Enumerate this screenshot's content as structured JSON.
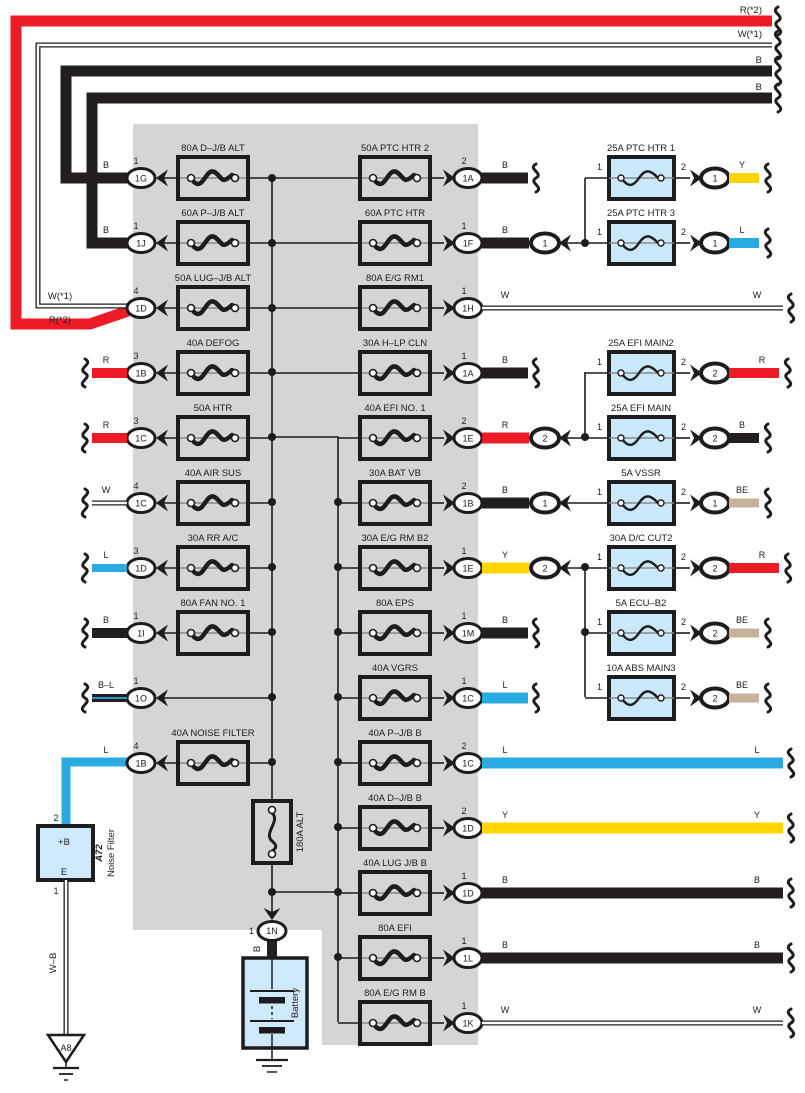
{
  "colors": {
    "R": "#EC1C27",
    "L": "#29ABE2",
    "Y": "#FFD400",
    "B": "#231F20",
    "BE": "#C7B299",
    "W": "#FFFFFF",
    "block_background": "#D4D5D7",
    "small_fuse_fill": "#C9E8FA",
    "component_fill": "#CDE9FA"
  },
  "top_wires": [
    {
      "label": "R(*2)",
      "near_label": "R(*2)",
      "color": "R"
    },
    {
      "label": "W(*1)",
      "near_label": "W(*1)",
      "color": "W"
    },
    {
      "label": "B",
      "color": "B"
    },
    {
      "label": "B",
      "color": "B"
    }
  ],
  "left_rows": [
    {
      "fuse": "80A D–J/B ALT",
      "pin": "1",
      "code": "1G",
      "wire": "B",
      "wire_code": "B",
      "src": "top"
    },
    {
      "fuse": "60A P–J/B ALT",
      "pin": "1",
      "code": "1J",
      "wire": "B",
      "wire_code": "B",
      "src": "top"
    },
    {
      "fuse": "50A LUG–J/B ALT",
      "pin": "4",
      "code": "1D",
      "wire": null,
      "wire_code": null,
      "src": "top"
    },
    {
      "fuse": "40A DEFOG",
      "pin": "3",
      "code": "1B",
      "wire": "R",
      "wire_code": "R",
      "src": "brace"
    },
    {
      "fuse": "50A HTR",
      "pin": "3",
      "code": "1C",
      "wire": "R",
      "wire_code": "R",
      "src": "brace"
    },
    {
      "fuse": "40A AIR SUS",
      "pin": "4",
      "code": "1C",
      "wire": "W",
      "wire_code": "W",
      "src": "brace"
    },
    {
      "fuse": "30A RR A/C",
      "pin": "3",
      "code": "1D",
      "wire": "L",
      "wire_code": "L",
      "src": "brace"
    },
    {
      "fuse": "80A FAN NO. 1",
      "pin": "1",
      "code": "1I",
      "wire": "B",
      "wire_code": "B",
      "src": "brace"
    },
    {
      "fuse": null,
      "pin": "1",
      "code": "1O",
      "wire": "B–L",
      "wire_code": "B-L",
      "src": "brace"
    },
    {
      "fuse": "40A NOISE FILTER",
      "pin": "4",
      "code": "1B",
      "wire": "L",
      "wire_code": "L",
      "src": "nf"
    }
  ],
  "middle_rows": [
    {
      "fuse": "50A PTC HTR 2",
      "pin": "2",
      "code": "1A",
      "wire": "B",
      "end": "short"
    },
    {
      "fuse": "60A PTC HTR",
      "pin": "1",
      "code": "1F",
      "wire": "B",
      "end": "oval",
      "oval": "1"
    },
    {
      "fuse": "80A E/G RM1",
      "pin": "1",
      "code": "1H",
      "wire": "W",
      "end": "long"
    },
    {
      "fuse": "30A H–LP CLN",
      "pin": "1",
      "code": "1A",
      "wire": "B",
      "end": "short"
    },
    {
      "fuse": "40A EFI NO. 1",
      "pin": "2",
      "code": "1E",
      "wire": "R",
      "end": "oval",
      "oval": "2"
    },
    {
      "fuse": "30A BAT VB",
      "pin": "2",
      "code": "1B",
      "wire": "B",
      "end": "oval",
      "oval": "1"
    },
    {
      "fuse": "30A E/G RM B2",
      "pin": "1",
      "code": "1E",
      "wire": "Y",
      "end": "oval",
      "oval": "2"
    },
    {
      "fuse": "80A EPS",
      "pin": "1",
      "code": "1M",
      "wire": "B",
      "end": "short"
    },
    {
      "fuse": "40A VGRS",
      "pin": "1",
      "code": "1C",
      "wire": "L",
      "end": "short"
    },
    {
      "fuse": "40A P–J/B B",
      "pin": "2",
      "code": "1C",
      "wire": "L",
      "end": "long"
    },
    {
      "fuse": "40A D–J/B B",
      "pin": "2",
      "code": "1D",
      "wire": "Y",
      "end": "long"
    },
    {
      "fuse": "40A LUG J/B B",
      "pin": "1",
      "code": "1D",
      "wire": "B",
      "end": "long"
    },
    {
      "fuse": "80A EFI",
      "pin": "1",
      "code": "1L",
      "wire": "B",
      "end": "long"
    },
    {
      "fuse": "80A E/G RM B",
      "pin": "1",
      "code": "1K",
      "wire": "W",
      "end": "long"
    }
  ],
  "right_fuses": [
    {
      "fuse": "25A PTC HTR 1",
      "row": 0,
      "pin_in": "1",
      "pin_out": "2",
      "oval": "1",
      "wire": "Y"
    },
    {
      "fuse": "25A PTC HTR 3",
      "row": 1,
      "pin_in": "1",
      "pin_out": "2",
      "oval": "1",
      "wire": "L"
    },
    {
      "fuse": "25A EFI MAIN2",
      "row": 3,
      "pin_in": "1",
      "pin_out": "2",
      "oval": "2",
      "wire": "R"
    },
    {
      "fuse": "25A EFI MAIN",
      "row": 4,
      "pin_in": "1",
      "pin_out": "2",
      "oval": "2",
      "wire": "B"
    },
    {
      "fuse": "5A VSSR",
      "row": 5,
      "pin_in": "1",
      "pin_out": "2",
      "oval": "1",
      "wire": "BE"
    },
    {
      "fuse": "30A D/C CUT2",
      "row": 6,
      "pin_in": "1",
      "pin_out": "2",
      "oval": "2",
      "wire": "R"
    },
    {
      "fuse": "5A ECU–B2",
      "row": 7,
      "pin_in": "1",
      "pin_out": "2",
      "oval": "2",
      "wire": "BE"
    },
    {
      "fuse": "10A ABS MAIN3",
      "row": 8,
      "pin_in": "1",
      "pin_out": "2",
      "oval": "2",
      "wire": "BE"
    }
  ],
  "alt_fuse": {
    "label": "180A ALT"
  },
  "battery": {
    "connector": "1N",
    "pin": "1",
    "wire": "B",
    "label": "Battery"
  },
  "noise_filter": {
    "pin_top": "2",
    "terminal_top": "+B",
    "terminal_bottom": "E",
    "pin_bottom": "1",
    "code": "A72",
    "name": "Noise Filter",
    "ground_wire": "W–B",
    "ground_code": "A8"
  }
}
